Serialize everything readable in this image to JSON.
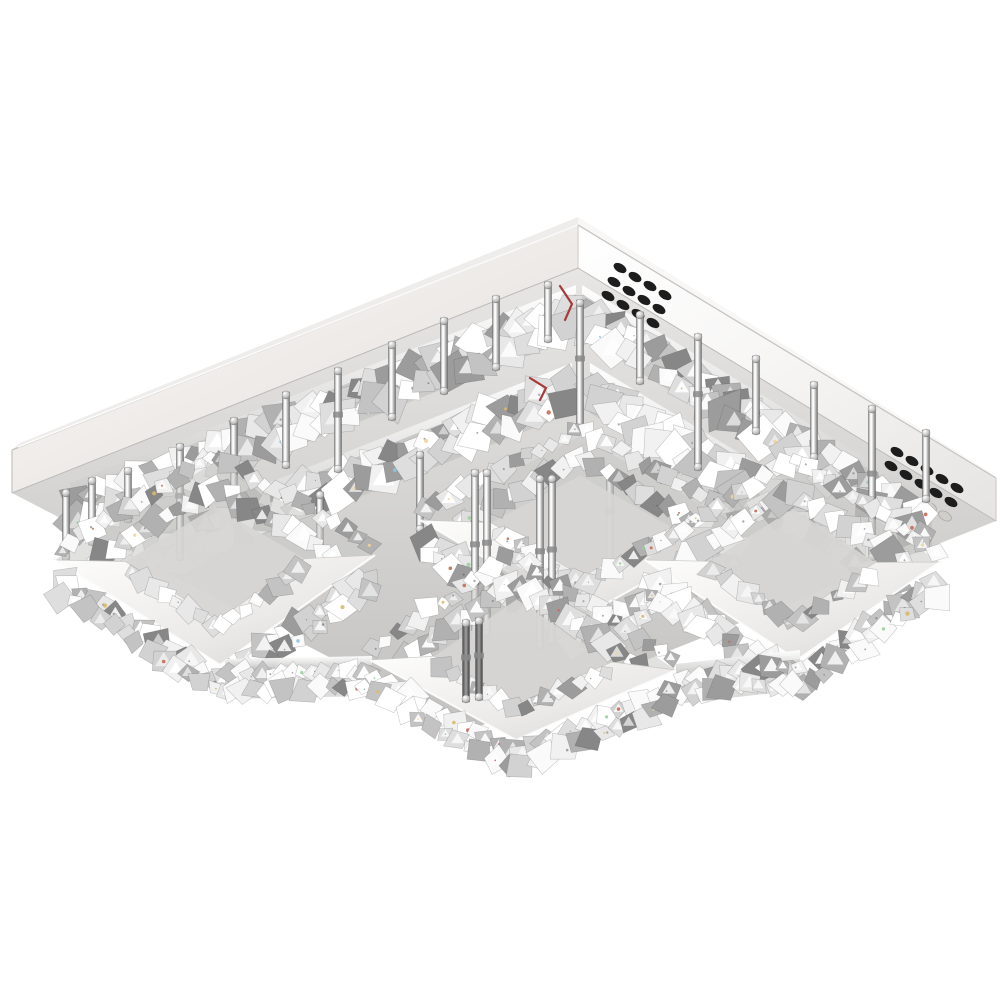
{
  "meta": {
    "subject": "square crystal LED flush-mount ceiling chandelier, chrome finish, viewed from below",
    "background_color": "#ffffff"
  },
  "scene": {
    "palette": {
      "plate_left_band": [
        "#fbfaf8",
        "#edeae7",
        "#d9d5d1"
      ],
      "plate_right_band": [
        "#ffffff",
        "#f7f6f5",
        "#e6e4e2"
      ],
      "plate_top_sliver_left": "#efedeb",
      "plate_top_sliver_right": "#f8f7f6",
      "underside": [
        "#e7e6e4",
        "#c3c2c0"
      ],
      "edge_line": "#c6c4c2",
      "vent_hole": "#1d1d1d",
      "vent_hole_faint_fill": "#d0cecb",
      "vent_hole_faint_stroke": "#a8a6a3",
      "ring_top": [
        "#fdfdfc",
        "#eceae8",
        "#d6d4d2"
      ],
      "ring_hole": "#d6d5d4",
      "band_shadow": "#bab9b8",
      "strip_chrome": [
        "#ffffff",
        "#cfcecd"
      ],
      "rod": [
        "#8e8e8e",
        "#f2f2f2",
        "#ffffff",
        "#bdbdbd",
        "#757575"
      ],
      "rod_dark": [
        "#4a4a4a",
        "#a0a0a0",
        "#3f3f3f"
      ],
      "crystal": [
        "#ffffff",
        "#fafafa",
        "#f1f1f1",
        "#e8e8e8",
        "#dedede",
        "#d2d2d2",
        "#c3c3c3",
        "#b1b1b1",
        "#9c9c9c",
        "#878787"
      ],
      "sparkle": [
        "#d9b96a",
        "#f0d49a",
        "#8fc3e0",
        "#c96a55",
        "#9ad0a0"
      ],
      "wire": "#a83a3a"
    },
    "plate": {
      "top_corner": [
        578,
        225
      ],
      "left_corner": [
        12,
        450
      ],
      "right_corner": [
        996,
        478
      ],
      "thickness": 43,
      "underside_near_corner": [
        470,
        730
      ]
    },
    "vents": {
      "angle_deg": 31,
      "rx": 7,
      "ry": 4.3,
      "clusters": [
        {
          "base": [
            620,
            268
          ],
          "cols": 4,
          "rows": 3,
          "col_step": [
            15,
            9
          ],
          "row_step": [
            -6,
            14
          ],
          "faint_last_row": false
        },
        {
          "base": [
            897,
            452
          ],
          "cols": 5,
          "rows": 3,
          "col_step": [
            15,
            9
          ],
          "row_step": [
            -6,
            14
          ],
          "faint_last_row": true
        }
      ]
    },
    "bands": [
      {
        "from": [
          70,
          489
        ],
        "to": [
          576,
          291
        ],
        "h": 46
      },
      {
        "from": [
          582,
          291
        ],
        "to": [
          932,
          505
        ],
        "h": 46
      },
      {
        "from": [
          124,
          546
        ],
        "to": [
          572,
          369
        ],
        "h": 44
      },
      {
        "from": [
          590,
          369
        ],
        "to": [
          902,
          557
        ],
        "h": 44
      }
    ],
    "connector_bands": [
      {
        "from": [
          225,
          665
        ],
        "to": [
          372,
          662
        ],
        "h": 34
      },
      {
        "from": [
          676,
          670
        ],
        "to": [
          800,
          656
        ],
        "h": 34
      }
    ],
    "rings": [
      {
        "name": "center",
        "W": [
          420,
          520
        ],
        "N": [
          580,
          436
        ],
        "E": [
          742,
          528
        ],
        "S": [
          584,
          616
        ],
        "k": 0.56
      },
      {
        "name": "left",
        "W": [
          55,
          560
        ],
        "N": [
          215,
          462
        ],
        "E": [
          375,
          555
        ],
        "S": [
          220,
          665
        ],
        "k": 0.56
      },
      {
        "name": "right",
        "W": [
          645,
          560
        ],
        "N": [
          793,
          466
        ],
        "E": [
          940,
          562
        ],
        "S": [
          797,
          660
        ],
        "k": 0.56
      },
      {
        "name": "front",
        "W": [
          370,
          660
        ],
        "N": [
          512,
          562
        ],
        "E": [
          676,
          670
        ],
        "S": [
          516,
          740
        ],
        "k": 0.58
      }
    ],
    "rods": {
      "upper": [
        [
          66,
          490,
          560
        ],
        [
          92,
          478,
          545
        ],
        [
          128,
          468,
          522
        ],
        [
          180,
          444,
          560
        ],
        [
          234,
          418,
          494
        ],
        [
          286,
          392,
          468
        ],
        [
          338,
          368,
          472
        ],
        [
          392,
          342,
          420
        ],
        [
          444,
          318,
          394
        ],
        [
          496,
          296,
          370
        ],
        [
          548,
          282,
          342
        ],
        [
          640,
          312,
          384
        ],
        [
          698,
          334,
          470
        ],
        [
          756,
          356,
          434
        ],
        [
          814,
          382,
          460
        ],
        [
          872,
          406,
          560
        ],
        [
          926,
          430,
          502
        ],
        [
          320,
          492,
          562
        ],
        [
          420,
          452,
          532
        ],
        [
          610,
          470,
          562
        ],
        [
          580,
          300,
          432
        ]
      ],
      "center": [
        [
          475,
          470,
          640
        ],
        [
          487,
          470,
          636
        ],
        [
          540,
          476,
          648
        ],
        [
          552,
          476,
          644
        ]
      ],
      "inner": [
        [
          466,
          620,
          702
        ],
        [
          479,
          618,
          700
        ]
      ],
      "width": 7
    },
    "wires": [
      {
        "points": [
          [
            560,
            286
          ],
          [
            572,
            304
          ],
          [
            565,
            320
          ]
        ]
      },
      {
        "points": [
          [
            530,
            378
          ],
          [
            546,
            388
          ],
          [
            540,
            400
          ]
        ]
      }
    ]
  }
}
